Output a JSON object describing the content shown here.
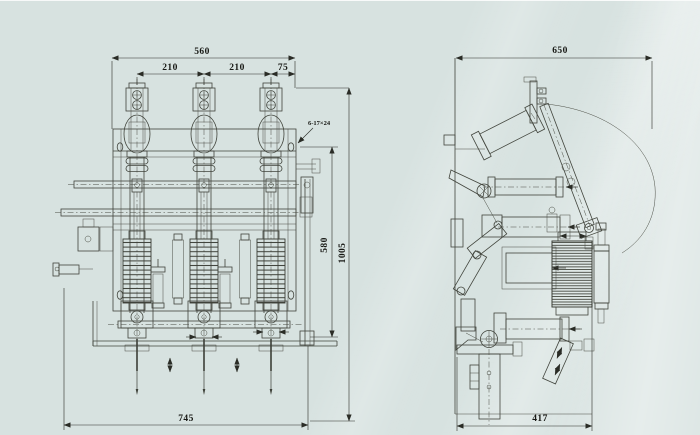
{
  "drawing": {
    "type": "technical-dimension-drawing",
    "colors": {
      "background": "#d7e2e0",
      "line": "#41443c",
      "dimension_text": "#171814"
    },
    "views": {
      "front": {
        "label": "front-view",
        "dimensions": {
          "overall_width": "560",
          "pitch_a": "210",
          "pitch_b": "210",
          "offset_right": "75",
          "mounting_holes": "6-17×24",
          "frame_height": "580",
          "overall_height": "1005",
          "base_width": "745"
        }
      },
      "side": {
        "label": "side-view",
        "dimensions": {
          "overall_depth": "650",
          "base_depth": "417"
        }
      }
    }
  }
}
